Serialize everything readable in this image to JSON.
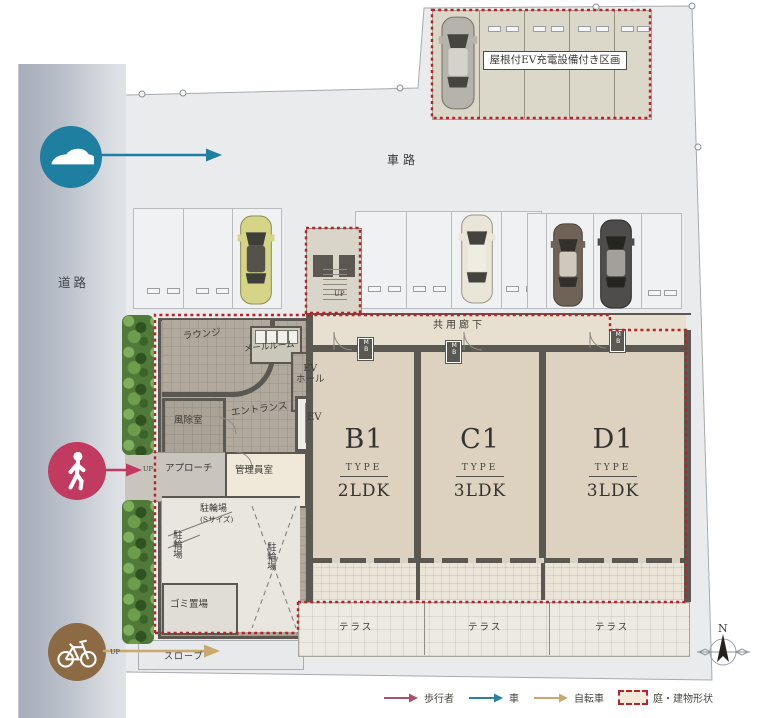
{
  "labels": {
    "road": "道路",
    "driveway": "車路",
    "ev_section": "屋根付EV充電設備付き区画",
    "common_corridor": "共用廊下",
    "lounge": "ラウンジ",
    "mail_room": "メールルーム",
    "windbreak_room": "風除室",
    "entrance": "エントランス",
    "ev_hall_line1": "EV",
    "ev_hall_line2": "ホール",
    "elevator": "EV",
    "approach": "アプローチ",
    "manager_room": "管理員室",
    "bike_storage": "駐輪場",
    "bike_storage_size": "(Sサイズ)",
    "bike_storage_left": "駐輪場",
    "bike_storage_right": "駐輪場",
    "garbage": "ゴミ置場",
    "slope": "スロープ",
    "up": "UP",
    "mb": "MB",
    "north": "N"
  },
  "units": [
    {
      "name": "B1",
      "type": "TYPE",
      "plan": "2LDK"
    },
    {
      "name": "C1",
      "type": "TYPE",
      "plan": "3LDK"
    },
    {
      "name": "D1",
      "type": "TYPE",
      "plan": "3LDK"
    }
  ],
  "terraces": [
    "テラス",
    "テラス",
    "テラス"
  ],
  "legend": [
    {
      "label": "歩行者",
      "color": "#a9506a",
      "swatch": "arrow"
    },
    {
      "label": "車",
      "color": "#2c7fa8",
      "swatch": "arrow"
    },
    {
      "label": "自転車",
      "color": "#c9a96e",
      "swatch": "arrow"
    },
    {
      "label": "庭・建物形状",
      "color": "#b3242c",
      "swatch": "dashed-box"
    }
  ],
  "colors": {
    "red_dash": "#b3242c",
    "car_icon_circle": "#1f7fa0",
    "pedestrian_icon_circle": "#c13a5f",
    "bicycle_icon_circle": "#8c6b44",
    "wall": "#5b5852",
    "unit_floor": "#ddd2bf",
    "road": "#b6bcc7"
  }
}
